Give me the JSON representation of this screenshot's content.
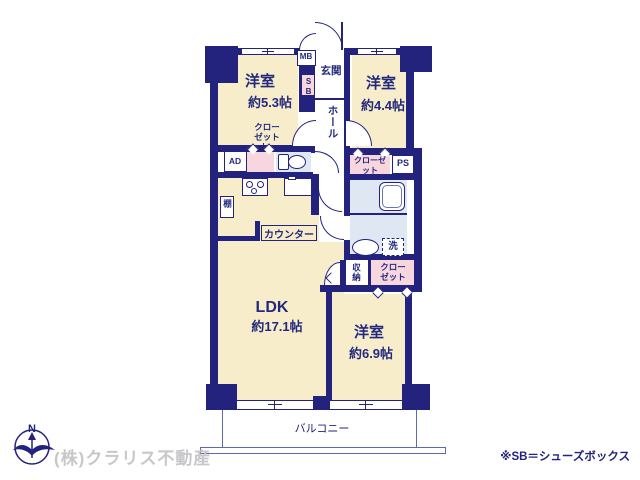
{
  "title": "マンション間取り図 (floor plan)",
  "plan": {
    "bedroom1_label": "洋室",
    "bedroom1_size": "約5.3帖",
    "bedroom2_label": "洋室",
    "bedroom2_size": "約4.4帖",
    "bedroom3_label": "洋室",
    "bedroom3_size": "約6.9帖",
    "ldk_label": "LDK",
    "ldk_size": "約17.1帖",
    "entrance": "玄関",
    "hall": "ホール",
    "balcony": "バルコニー",
    "counter": "カウンター",
    "shelf": "棚",
    "storage": "収納",
    "washer": "洗",
    "closet": "クローゼット",
    "mb": "MB",
    "sb": "SB",
    "ad": "AD",
    "ps": "PS"
  },
  "footer": {
    "company": "(株)クラリス不動産",
    "note": "※SB＝シューズボックス",
    "compass_north": "N"
  },
  "colors": {
    "wall": "#23237d",
    "room_fill": "#f7edcb",
    "closet_fill": "#f8d6de",
    "wet_area_fill": "#dfe7f3",
    "text": "#232a7d",
    "watermark": "#c7c7c9",
    "background": "#ffffff"
  }
}
